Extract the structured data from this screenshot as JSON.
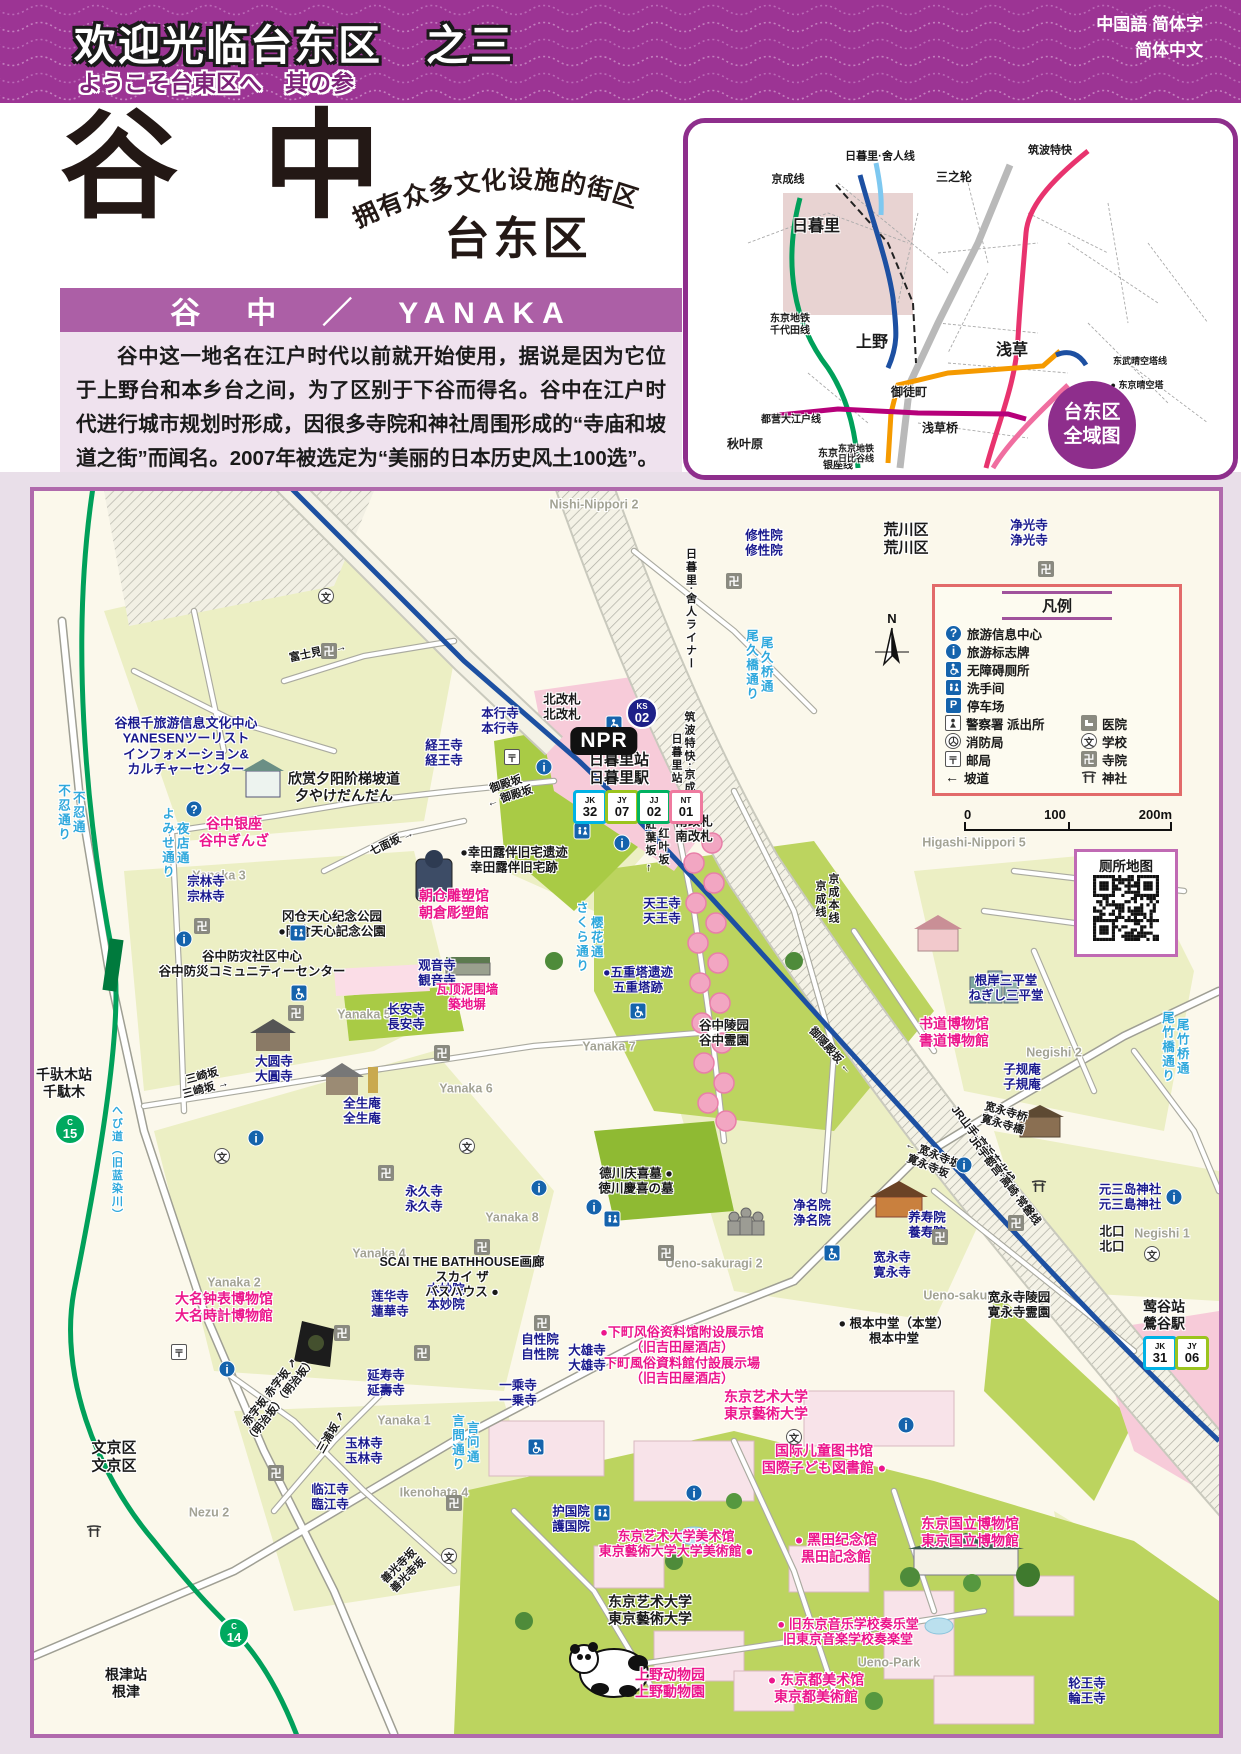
{
  "header": {
    "title_cn": "欢迎光临台东区　之三",
    "subtitle_jp": "ようこそ台東区へ　其の参",
    "lang_line1": "中国語 简体字",
    "lang_line2": "简体中文"
  },
  "title_block": {
    "main_title": "谷 中",
    "tagline": "拥有众多文化设施的街区",
    "district": "台东区",
    "name_bar": "谷　中　／　YANAKA"
  },
  "intro": {
    "paragraph": "谷中这一地名在江户时代以前就开始使用，据说是因为它位于上野台和本乡台之间，为了区别于下谷而得名。谷中在江户时代进行城市规划时形成，因很多寺院和神社周围形成的“寺庙和坡道之街”而闻名。2007年被选定为“美丽的日本历史风土100选”。"
  },
  "overview": {
    "badge_line1": "台东区",
    "badge_line2": "全域图",
    "labels": [
      {
        "t": "京成线",
        "x": 100,
        "y": 57,
        "s": 11
      },
      {
        "t": "日暮里·舍人线",
        "x": 192,
        "y": 34,
        "s": 11
      },
      {
        "t": "三之轮",
        "x": 266,
        "y": 55,
        "s": 12
      },
      {
        "t": "筑波特快",
        "x": 362,
        "y": 28,
        "s": 11
      },
      {
        "t": "日暮里",
        "x": 128,
        "y": 104,
        "s": 16
      },
      {
        "t": "东京地铁\n千代田线",
        "x": 102,
        "y": 202,
        "s": 10
      },
      {
        "t": "上野",
        "x": 184,
        "y": 220,
        "s": 16
      },
      {
        "t": "浅草",
        "x": 324,
        "y": 228,
        "s": 16
      },
      {
        "t": "御徒町",
        "x": 221,
        "y": 270,
        "s": 12
      },
      {
        "t": "都营大江户线",
        "x": 103,
        "y": 297,
        "s": 10
      },
      {
        "t": "东京地铁\n银座线",
        "x": 150,
        "y": 337,
        "s": 10
      },
      {
        "t": "东武晴空塔线",
        "x": 452,
        "y": 238,
        "s": 9
      },
      {
        "t": "● 东京晴空塔",
        "x": 449,
        "y": 262,
        "s": 9
      },
      {
        "t": "都营浅草线",
        "x": 396,
        "y": 278,
        "s": 9
      },
      {
        "t": "秋叶原",
        "x": 57,
        "y": 322,
        "s": 12
      },
      {
        "t": "东京地铁\n日比谷线",
        "x": 168,
        "y": 331,
        "s": 9
      },
      {
        "t": "浅草桥",
        "x": 252,
        "y": 306,
        "s": 12
      }
    ]
  },
  "legend": {
    "title": "凡例",
    "rows": [
      {
        "i": "q",
        "l": "旅游信息中心"
      },
      {
        "i": "i",
        "l": "旅游标志牌"
      },
      {
        "i": "wc",
        "l": "无障碍厕所"
      },
      {
        "i": "rr",
        "l": "洗手间"
      },
      {
        "i": "p",
        "l": "停车场"
      },
      {
        "i": "pl",
        "l": "警察署 派出所",
        "i2": "ho",
        "l2": "医院"
      },
      {
        "i": "fi",
        "l": "消防局",
        "i2": "sc",
        "l2": "学校"
      },
      {
        "i": "po",
        "l": "邮局",
        "i2": "tp",
        "l2": "寺院"
      },
      {
        "i": "sl",
        "l": "坡道",
        "i2": "sh",
        "l2": "神社"
      }
    ]
  },
  "scale": {
    "t0": "0",
    "t1": "100",
    "t2": "200m"
  },
  "qr": {
    "title": "厕所地图"
  },
  "map": {
    "npr_label": "NPR",
    "north_label": "N",
    "labels": [
      {
        "t": "Nishi-Nippori 2",
        "x": 560,
        "y": 14,
        "c": "g"
      },
      {
        "t": "荒川区\n荒川区",
        "x": 872,
        "y": 48,
        "c": "k",
        "s": 15
      },
      {
        "t": "Higashi-Nippori 5",
        "x": 940,
        "y": 352,
        "c": "g"
      },
      {
        "t": "Yanaka 3",
        "x": 185,
        "y": 385,
        "c": "g"
      },
      {
        "t": "Yanaka 5",
        "x": 330,
        "y": 524,
        "c": "g"
      },
      {
        "t": "Yanaka 7",
        "x": 575,
        "y": 556,
        "c": "g"
      },
      {
        "t": "Yanaka 6",
        "x": 432,
        "y": 598,
        "c": "g"
      },
      {
        "t": "Yanaka 8",
        "x": 478,
        "y": 727,
        "c": "g"
      },
      {
        "t": "Yanaka 4",
        "x": 345,
        "y": 763,
        "c": "g"
      },
      {
        "t": "Yanaka 2",
        "x": 200,
        "y": 792,
        "c": "g"
      },
      {
        "t": "Yanaka 1",
        "x": 370,
        "y": 930,
        "c": "g"
      },
      {
        "t": "Nezu 2",
        "x": 175,
        "y": 1022,
        "c": "g"
      },
      {
        "t": "Negishi 2",
        "x": 1020,
        "y": 562,
        "c": "g"
      },
      {
        "t": "Negishi 1",
        "x": 1128,
        "y": 743,
        "c": "g"
      },
      {
        "t": "Ueno-sakuragi 2",
        "x": 680,
        "y": 773,
        "c": "g"
      },
      {
        "t": "Ueno-sakuragi 1",
        "x": 938,
        "y": 805,
        "c": "g"
      },
      {
        "t": "Ueno-Park",
        "x": 855,
        "y": 1172,
        "c": "g"
      },
      {
        "t": "Ikenohata 4",
        "x": 400,
        "y": 1002,
        "c": "g"
      },
      {
        "t": "文京区\n文京区",
        "x": 80,
        "y": 966,
        "c": "k",
        "s": 15
      },
      {
        "t": "修性院\n修性院",
        "x": 730,
        "y": 52,
        "c": "b"
      },
      {
        "t": "净光寺\n浄光寺",
        "x": 995,
        "y": 42,
        "c": "b"
      },
      {
        "t": "経王寺\n経王寺",
        "x": 410,
        "y": 262,
        "c": "b"
      },
      {
        "t": "本行寺\n本行寺",
        "x": 466,
        "y": 230,
        "c": "b"
      },
      {
        "t": "宗林寺\n宗林寺",
        "x": 172,
        "y": 398,
        "c": "b"
      },
      {
        "t": "天王寺\n天王寺",
        "x": 628,
        "y": 420,
        "c": "b"
      },
      {
        "t": "观音寺\n観音寺",
        "x": 403,
        "y": 482,
        "c": "b"
      },
      {
        "t": "长安寺\n長安寺",
        "x": 372,
        "y": 526,
        "c": "b"
      },
      {
        "t": "大圆寺\n大圓寺",
        "x": 240,
        "y": 578,
        "c": "b"
      },
      {
        "t": "全生庵\n全生庵",
        "x": 328,
        "y": 620,
        "c": "b"
      },
      {
        "t": "永久寺\n永久寺",
        "x": 390,
        "y": 708,
        "c": "b"
      },
      {
        "t": "莲华寺\n蓮華寺",
        "x": 356,
        "y": 813,
        "c": "b"
      },
      {
        "t": "本妙院\n本妙院",
        "x": 412,
        "y": 806,
        "c": "b"
      },
      {
        "t": "延寿寺\n延壽寺",
        "x": 352,
        "y": 892,
        "c": "b"
      },
      {
        "t": "玉林寺\n玉林寺",
        "x": 330,
        "y": 960,
        "c": "b"
      },
      {
        "t": "临江寺\n臨江寺",
        "x": 296,
        "y": 1006,
        "c": "b"
      },
      {
        "t": "自性院\n自性院",
        "x": 506,
        "y": 856,
        "c": "b"
      },
      {
        "t": "大雄寺\n大雄寺",
        "x": 553,
        "y": 867,
        "c": "b"
      },
      {
        "t": "一乘寺\n一乗寺",
        "x": 484,
        "y": 902,
        "c": "b"
      },
      {
        "t": "净名院\n浄名院",
        "x": 778,
        "y": 722,
        "c": "b"
      },
      {
        "t": "养寿院\n養寿院",
        "x": 893,
        "y": 734,
        "c": "b"
      },
      {
        "t": "宽永寺\n寛永寺",
        "x": 858,
        "y": 774,
        "c": "b"
      },
      {
        "t": "护国院\n護国院",
        "x": 537,
        "y": 1028,
        "c": "b"
      },
      {
        "t": "子规庵\n子規庵",
        "x": 988,
        "y": 586,
        "c": "b"
      },
      {
        "t": "根岸三平堂\nねぎし三平堂",
        "x": 972,
        "y": 497,
        "c": "b"
      },
      {
        "t": "元三岛神社\n元三島神社",
        "x": 1096,
        "y": 706,
        "c": "b"
      },
      {
        "t": "轮王寺\n輪王寺",
        "x": 1053,
        "y": 1200,
        "c": "b"
      },
      {
        "t": "●五重塔遗迹\n五重塔跡",
        "x": 604,
        "y": 489,
        "c": "b"
      },
      {
        "t": "谷根千旅游信息文化中心\nYANESENツーリスト\nインフォメーション&\nカルチャーセンター",
        "x": 152,
        "y": 255,
        "c": "b",
        "s": 13
      },
      {
        "t": "欣赏夕阳阶梯坡道\n夕やけだんだん",
        "x": 310,
        "y": 296,
        "c": "k",
        "s": 14
      },
      {
        "t": "冈仓天心纪念公园\n●岡倉天心記念公園",
        "x": 298,
        "y": 433,
        "c": "k"
      },
      {
        "t": "谷中防灾社区中心\n谷中防災コミュニティーセンター",
        "x": 218,
        "y": 473,
        "c": "k"
      },
      {
        "t": "●幸田露伴旧宅遗迹\n幸田露伴旧宅跡",
        "x": 480,
        "y": 369,
        "c": "k"
      },
      {
        "t": "谷中陵园\n谷中霊園",
        "x": 690,
        "y": 542,
        "c": "k"
      },
      {
        "t": "德川庆喜墓 ●\n徳川慶喜の墓",
        "x": 602,
        "y": 690,
        "c": "k"
      },
      {
        "t": "SCAI THE BATHHOUSE画廊\nスカイ ザ\nバスハウス ●",
        "x": 428,
        "y": 786,
        "c": "k"
      },
      {
        "t": "● 根本中堂（本堂）\n根本中堂",
        "x": 860,
        "y": 840,
        "c": "k"
      },
      {
        "t": "宽永寺陵园\n寛永寺霊園",
        "x": 985,
        "y": 814,
        "c": "k"
      },
      {
        "t": "北改札\n北改札",
        "x": 528,
        "y": 216,
        "c": "k"
      },
      {
        "t": "南改札\n南改札",
        "x": 660,
        "y": 338,
        "c": "k"
      },
      {
        "t": "北口\n北口",
        "x": 1078,
        "y": 748,
        "c": "k"
      },
      {
        "t": "莺谷站\n鶯谷駅",
        "x": 1130,
        "y": 824,
        "c": "k",
        "s": 14
      },
      {
        "t": "千驮木站\n千駄木",
        "x": 30,
        "y": 592,
        "c": "k",
        "s": 14
      },
      {
        "t": "日暮里站\n日暮里駅",
        "x": 585,
        "y": 278,
        "c": "k",
        "s": 15
      },
      {
        "t": "东京艺术大学\n東京藝術大学",
        "x": 616,
        "y": 1119,
        "c": "k",
        "s": 14
      },
      {
        "t": "根津站\n根津",
        "x": 92,
        "y": 1192,
        "c": "k",
        "s": 14
      },
      {
        "t": "谷中银座\n谷中ぎんざ",
        "x": 200,
        "y": 341,
        "c": "p",
        "s": 14
      },
      {
        "t": "朝仓雕塑馆\n朝倉彫塑館",
        "x": 420,
        "y": 413,
        "c": "p",
        "s": 14
      },
      {
        "t": "瓦顶泥围墙\n築地塀",
        "x": 433,
        "y": 506,
        "c": "p"
      },
      {
        "t": "大名钟表博物馆\n大名時計博物館",
        "x": 190,
        "y": 816,
        "c": "p",
        "s": 14
      },
      {
        "t": "书道博物馆\n書道博物館",
        "x": 920,
        "y": 541,
        "c": "p",
        "s": 14
      },
      {
        "t": "●下町风俗资料馆附设展示馆\n（旧吉田屋酒店）\n下町風俗資料館付設展示場\n（旧吉田屋酒店）",
        "x": 648,
        "y": 864,
        "c": "p",
        "s": 13
      },
      {
        "t": "东京艺术大学\n東京藝術大学",
        "x": 732,
        "y": 914,
        "c": "p",
        "s": 14
      },
      {
        "t": "国际儿童图书馆\n国際子ども図書館 ●",
        "x": 790,
        "y": 968,
        "c": "p",
        "s": 14
      },
      {
        "t": "东京艺术大学美术馆\n東京藝術大学大学美術館 ●",
        "x": 642,
        "y": 1053,
        "c": "p",
        "s": 13
      },
      {
        "t": "● 黑田纪念馆\n黒田記念館",
        "x": 802,
        "y": 1057,
        "c": "p",
        "s": 14
      },
      {
        "t": "● 旧东京音乐学校奏乐堂\n旧東京音楽学校奏楽堂",
        "x": 814,
        "y": 1141,
        "c": "p",
        "s": 13
      },
      {
        "t": "● 东京都美术馆\n東京都美術館",
        "x": 782,
        "y": 1197,
        "c": "p",
        "s": 14
      },
      {
        "t": "上野动物园\n上野動物園",
        "x": 636,
        "y": 1192,
        "c": "p",
        "s": 14
      },
      {
        "t": "东京国立博物馆\n東京国立博物館",
        "x": 936,
        "y": 1041,
        "c": "p",
        "s": 14
      },
      {
        "t": "不忍通\n不忍通り",
        "x": 36,
        "y": 322,
        "c": "lb",
        "v": 1
      },
      {
        "t": "夜店通\nよみせ通り",
        "x": 140,
        "y": 352,
        "c": "lb",
        "v": 1
      },
      {
        "t": "樱花通\nさくら通り",
        "x": 554,
        "y": 446,
        "c": "lb",
        "v": 1
      },
      {
        "t": "へび道（旧蓝染川）",
        "x": 82,
        "y": 672,
        "c": "lb",
        "v": 1,
        "s": 11
      },
      {
        "t": "言问通\n言問通り",
        "x": 430,
        "y": 952,
        "c": "lb",
        "v": 1
      },
      {
        "t": "尾竹桥通\n尾竹橋通り",
        "x": 1140,
        "y": 556,
        "c": "lb",
        "v": 1
      },
      {
        "t": "尾久桥通\n尾久橋通り",
        "x": 724,
        "y": 174,
        "c": "lb",
        "v": 1
      },
      {
        "t": "日暮里·舍人ライナー",
        "x": 656,
        "y": 118,
        "c": "k",
        "v": 1,
        "s": 11
      },
      {
        "t": "筑波特快·京成线\n日暮里站",
        "x": 648,
        "y": 268,
        "c": "k",
        "v": 1,
        "s": 11
      },
      {
        "t": "京成本线\n京成线",
        "x": 792,
        "y": 408,
        "c": "k",
        "v": 1,
        "s": 11
      },
      {
        "t": "JR山手·京浜东北线",
        "x": 948,
        "y": 654,
        "c": "k",
        "r": 52,
        "s": 11
      },
      {
        "t": "JR宇都宫·高崎·常磐线",
        "x": 970,
        "y": 690,
        "c": "k",
        "r": 52,
        "s": 11
      },
      {
        "t": "御殿坂\n← 御殿坂",
        "x": 474,
        "y": 300,
        "c": "k",
        "r": -18,
        "s": 11
      },
      {
        "t": "七面坂 →",
        "x": 358,
        "y": 352,
        "c": "k",
        "r": -25,
        "s": 11
      },
      {
        "t": "富士見坂 →",
        "x": 284,
        "y": 162,
        "c": "k",
        "r": -12,
        "s": 11
      },
      {
        "t": "三崎坂\n三崎坂 →",
        "x": 170,
        "y": 592,
        "c": "k",
        "r": -15,
        "s": 11
      },
      {
        "t": "红叶坂\n紅葉坂 ←",
        "x": 622,
        "y": 356,
        "c": "k",
        "v": 1,
        "s": 11
      },
      {
        "t": "御隠殿坂 ←",
        "x": 796,
        "y": 560,
        "c": "k",
        "r": 48,
        "s": 11
      },
      {
        "t": "← 宽永寺坂\n寛永寺坂",
        "x": 896,
        "y": 670,
        "c": "k",
        "r": 22,
        "s": 11
      },
      {
        "t": "宽永寺桥\n寛永寺橋",
        "x": 970,
        "y": 628,
        "c": "k",
        "r": 16,
        "s": 11
      },
      {
        "t": "赤字坂 赤字坂 ↗\n（明治坂）（明治坂）",
        "x": 242,
        "y": 906,
        "c": "k",
        "r": -52,
        "s": 11
      },
      {
        "t": "三浦坂 ↗",
        "x": 298,
        "y": 942,
        "c": "k",
        "r": -60,
        "s": 11
      },
      {
        "t": "善光寺坂\n善光寺坂",
        "x": 370,
        "y": 1080,
        "c": "k",
        "r": -45,
        "s": 11
      }
    ],
    "icons": [
      {
        "k": "q",
        "x": 160,
        "y": 318
      },
      {
        "k": "i",
        "x": 510,
        "y": 276
      },
      {
        "k": "i",
        "x": 588,
        "y": 352
      },
      {
        "k": "i",
        "x": 150,
        "y": 448
      },
      {
        "k": "i",
        "x": 222,
        "y": 647
      },
      {
        "k": "i",
        "x": 193,
        "y": 878
      },
      {
        "k": "i",
        "x": 560,
        "y": 716
      },
      {
        "k": "i",
        "x": 930,
        "y": 674
      },
      {
        "k": "i",
        "x": 1140,
        "y": 706
      },
      {
        "k": "i",
        "x": 872,
        "y": 934
      },
      {
        "k": "i",
        "x": 660,
        "y": 1002
      },
      {
        "k": "i",
        "x": 505,
        "y": 697
      },
      {
        "k": "wc",
        "x": 580,
        "y": 233
      },
      {
        "k": "wc",
        "x": 265,
        "y": 502
      },
      {
        "k": "wc",
        "x": 604,
        "y": 520
      },
      {
        "k": "wc",
        "x": 798,
        "y": 762
      },
      {
        "k": "wc",
        "x": 502,
        "y": 956
      },
      {
        "k": "rr",
        "x": 264,
        "y": 442
      },
      {
        "k": "rr",
        "x": 548,
        "y": 340
      },
      {
        "k": "rr",
        "x": 578,
        "y": 728
      },
      {
        "k": "rr",
        "x": 568,
        "y": 1022
      },
      {
        "k": "sh",
        "x": 1005,
        "y": 695
      },
      {
        "k": "sh",
        "x": 60,
        "y": 1040
      },
      {
        "k": "sc",
        "x": 188,
        "y": 665
      },
      {
        "k": "sc",
        "x": 433,
        "y": 655
      },
      {
        "k": "sc",
        "x": 760,
        "y": 946
      },
      {
        "k": "sc",
        "x": 415,
        "y": 1065
      },
      {
        "k": "sc",
        "x": 292,
        "y": 105
      },
      {
        "k": "sc",
        "x": 1118,
        "y": 763
      },
      {
        "k": "po",
        "x": 478,
        "y": 266
      },
      {
        "k": "po",
        "x": 145,
        "y": 861
      },
      {
        "k": "tp",
        "x": 295,
        "y": 160
      },
      {
        "k": "tp",
        "x": 700,
        "y": 90
      },
      {
        "k": "tp",
        "x": 1012,
        "y": 78
      },
      {
        "k": "tp",
        "x": 168,
        "y": 435
      },
      {
        "k": "tp",
        "x": 262,
        "y": 522
      },
      {
        "k": "tp",
        "x": 408,
        "y": 562
      },
      {
        "k": "tp",
        "x": 352,
        "y": 682
      },
      {
        "k": "tp",
        "x": 448,
        "y": 756
      },
      {
        "k": "tp",
        "x": 308,
        "y": 842
      },
      {
        "k": "tp",
        "x": 388,
        "y": 862
      },
      {
        "k": "tp",
        "x": 508,
        "y": 832
      },
      {
        "k": "tp",
        "x": 632,
        "y": 762
      },
      {
        "k": "tp",
        "x": 906,
        "y": 746
      },
      {
        "k": "tp",
        "x": 242,
        "y": 982
      },
      {
        "k": "tp",
        "x": 420,
        "y": 1012
      },
      {
        "k": "tp",
        "x": 982,
        "y": 732
      }
    ],
    "badges": [
      {
        "t": "KS",
        "n": "02",
        "shape": "circle",
        "col": "#1D2088",
        "x": 608,
        "y": 222
      },
      {
        "t": "JK",
        "n": "32",
        "col": "#00B2E5",
        "x": 556,
        "y": 316
      },
      {
        "t": "JY",
        "n": "07",
        "col": "#9BC41E",
        "x": 588,
        "y": 316
      },
      {
        "t": "JJ",
        "n": "02",
        "col": "#00B261",
        "x": 620,
        "y": 316
      },
      {
        "t": "NT",
        "n": "01",
        "col": "#EF7A9F",
        "x": 652,
        "y": 316
      },
      {
        "t": "JK",
        "n": "31",
        "col": "#00B2E5",
        "x": 1126,
        "y": 862
      },
      {
        "t": "JY",
        "n": "06",
        "col": "#9BC41E",
        "x": 1158,
        "y": 862
      },
      {
        "t": "C",
        "n": "15",
        "shape": "circle",
        "col": "#00A95F",
        "x": 36,
        "y": 638
      },
      {
        "t": "C",
        "n": "14",
        "shape": "circle",
        "col": "#00A95F",
        "x": 200,
        "y": 1142
      }
    ]
  }
}
